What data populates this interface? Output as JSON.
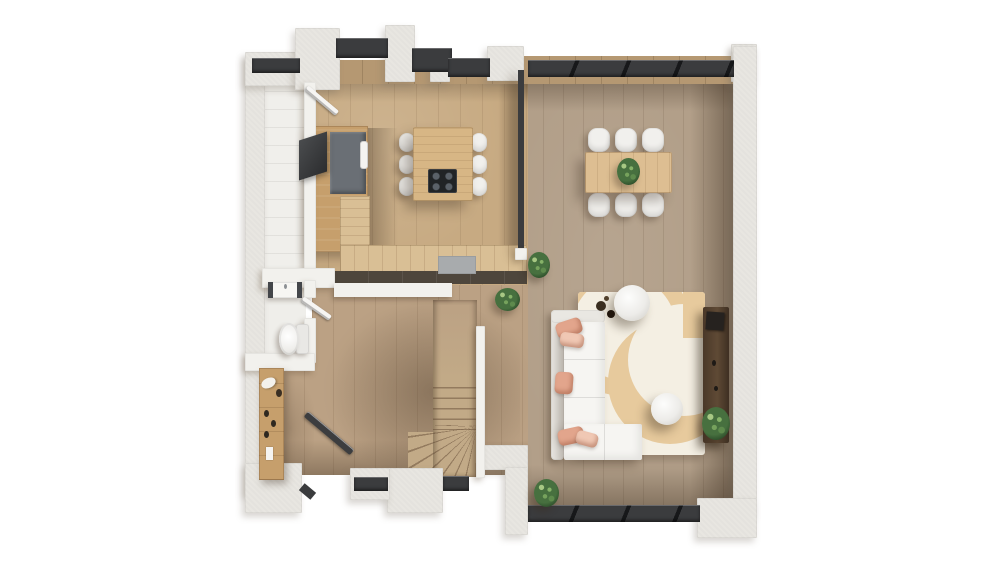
{
  "scene": {
    "type": "architectural-floor-plan-3d-render",
    "view": "top-down",
    "description": "Photorealistic top-down render of an open-plan ground floor with kitchen, dining area, living area, WC, hallway, utility room and winder staircase on a white backdrop",
    "visible_text": "none",
    "background_color": "#ffffff"
  },
  "palette": {
    "bg": "#ffffff",
    "wall": "#E8E6E1",
    "window_frame": "#3B3C3E",
    "sill_wood": "#B59872",
    "floor_kitchen": "#C7AA82",
    "floor_hall": "#BBA184",
    "floor_living": "#B29F89",
    "floor_utility": "#F0EFEB",
    "floor_wc": "#EFEEEA",
    "counter_wood": "#C69F6C",
    "counter_top": "#D9BF95",
    "counter_gray": "#6A6F75",
    "counter_base": "#4E463C",
    "island_wood": "#D7B685",
    "cooktop": "#212426",
    "seat_white": "#F1F0ED",
    "table_wood": "#DDBE92",
    "sofa_white": "#F6F5F2",
    "sofa_back": "#E9E7E2",
    "pillow": "#E2A58C",
    "pillow_light": "#F0C8B4",
    "rug": "#F4EFE3",
    "rug_pattern": "#E7CA9D",
    "sideboard": "#57432F",
    "stair_wood": "#C2AA87",
    "plant": "#47703F",
    "plant_dark": "#2E4F2B",
    "door_dark": "#3C3D3F",
    "door_white": "#F6F5F3"
  },
  "rooms": [
    {
      "name": "kitchen",
      "position": "top-left",
      "furniture": [
        "l-shaped-counter",
        "slate-countertop-section",
        "sink",
        "dark-built-in-appliance",
        "kitchen-island",
        "black-cooktop"
      ],
      "bar_stools": 6
    },
    {
      "name": "dining-area",
      "position": "top-right",
      "furniture": [
        "rectangular-dining-table",
        "table-centerpiece-plant"
      ],
      "dining_chairs": 6
    },
    {
      "name": "living-area",
      "position": "bottom-right",
      "furniture": [
        "corner-sofa",
        "area-rug-with-tan-arcs",
        "round-coffee-table-large",
        "round-coffee-table-small",
        "decor-tray",
        "media-sideboard"
      ],
      "accent_pillows": 5
    },
    {
      "name": "wc",
      "position": "mid-left",
      "furniture": [
        "washbasin",
        "toilet",
        "interior-door"
      ]
    },
    {
      "name": "hallway",
      "position": "bottom-left",
      "furniture": [
        "wardrobe-with-shoes",
        "entrance-door"
      ]
    },
    {
      "name": "utility-room",
      "position": "far-left",
      "furniture": [
        "interior-door"
      ]
    },
    {
      "name": "staircase",
      "position": "bottom-center",
      "furniture": [
        "winder-stairs",
        "stair-spine-wall"
      ]
    }
  ],
  "openings": {
    "kitchen_clerestory_windows": 3,
    "corner_window_top_left": 1,
    "dining_window_band": 1,
    "hall_windows": 2,
    "living_sliding_glass_door": 1,
    "doors": [
      "entrance-door",
      "wc-door",
      "utility-door"
    ]
  },
  "plants": {
    "count": 5,
    "locations": [
      "dining-table",
      "partition-end",
      "living-edge",
      "living-bottom",
      "sideboard-end"
    ]
  }
}
